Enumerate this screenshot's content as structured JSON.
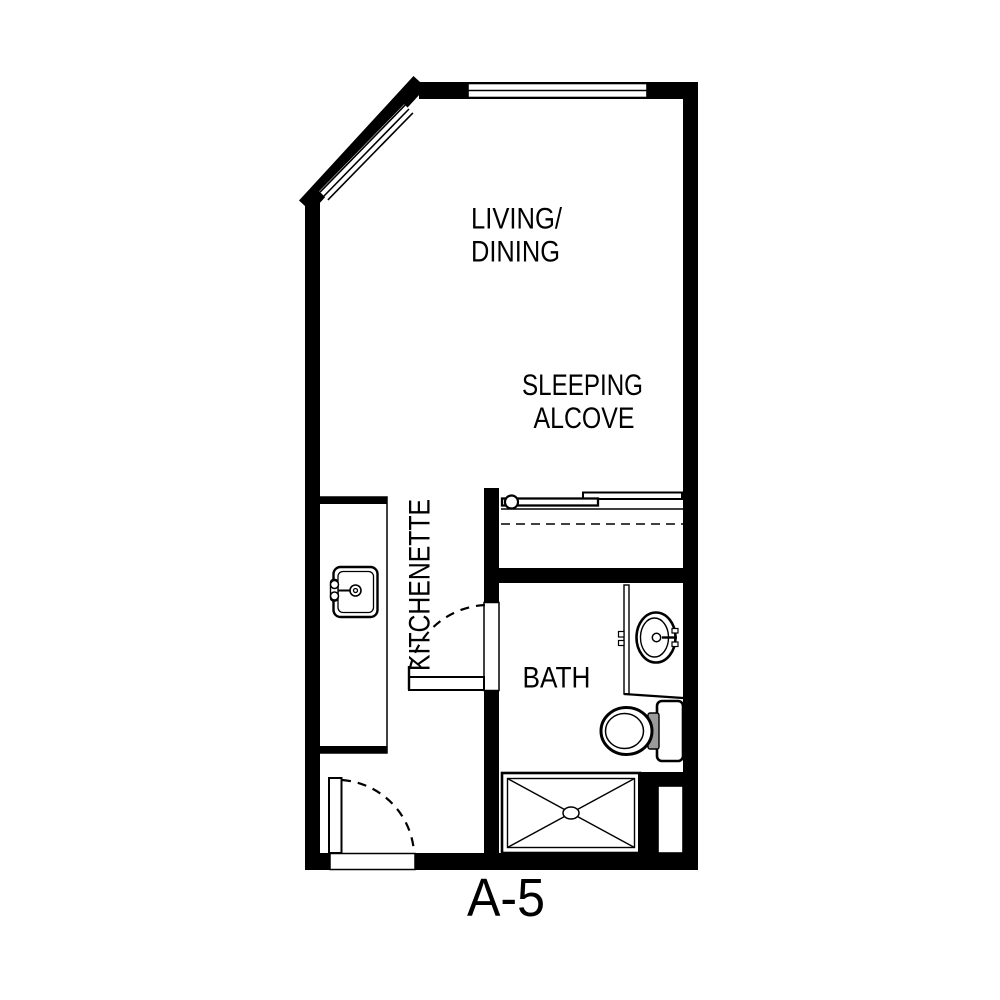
{
  "floor_plan": {
    "unit_label": "A-5",
    "rooms": {
      "living_dining": {
        "line1": "LIVING/",
        "line2": "DINING"
      },
      "sleeping_alcove": {
        "line1": "SLEEPING",
        "line2": "ALCOVE"
      },
      "kitchenette": {
        "label": "KITCHENETTE"
      },
      "bath": {
        "label": "BATH"
      }
    },
    "fixtures": {
      "kitchen_sink": "kitchen-sink",
      "vanity_sink": "vanity-sink",
      "toilet": "toilet",
      "shower": "shower",
      "closet": "sliding-door-closet",
      "doors": [
        "entry-door",
        "bath-door"
      ],
      "windows": [
        "top-window",
        "angled-window"
      ]
    },
    "colors": {
      "wall": "#000000",
      "background": "#ffffff",
      "fixture_fill": "#ffffff",
      "toilet_connector": "#9a9a9a"
    }
  }
}
